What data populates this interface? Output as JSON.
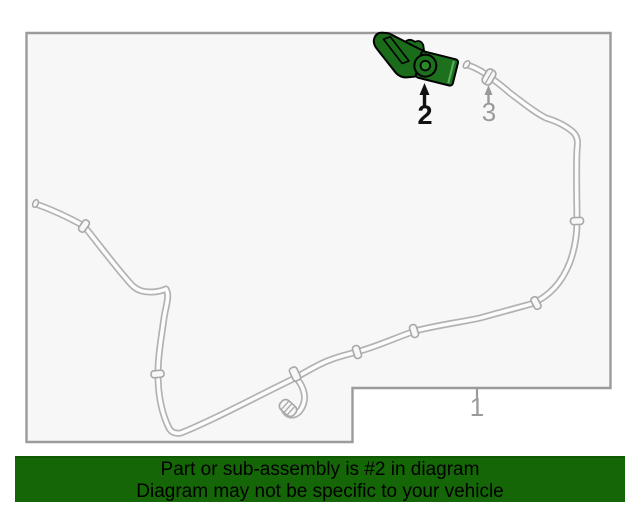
{
  "page": {
    "background": "#ffffff"
  },
  "diagram": {
    "area_fill": "#f7f7f7",
    "border_color": "#9b9b9b",
    "tube_line_color": "#b2b2b2",
    "highlight_color": "#1d701d",
    "callouts": [
      {
        "label": "1",
        "highlighted": false
      },
      {
        "label": "2",
        "highlighted": true
      },
      {
        "label": "3",
        "highlighted": false
      }
    ]
  },
  "banner": {
    "line1": "Part or sub-assembly is #2 in diagram",
    "line2": "Diagram may not be specific to your vehicle",
    "background": "#146606",
    "text_color": "#000000"
  }
}
